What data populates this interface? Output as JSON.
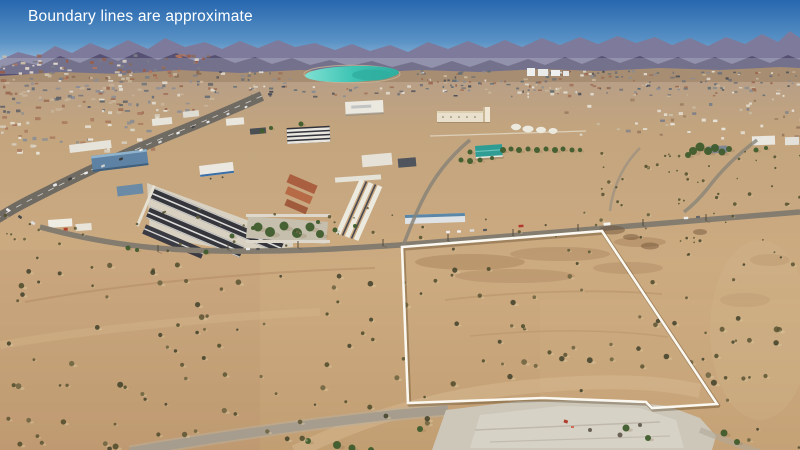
{
  "caption": {
    "text": "Boundary lines are approximate"
  },
  "palette": {
    "sky_top": "#2767ae",
    "sky_mid": "#5b93c6",
    "sky_horizon": "#aac6dd",
    "mtn_far": "#7d7a9b",
    "mtn_near": "#565072",
    "foothills": "#a78d72",
    "desert_distant": "#b89f86",
    "desert_mid": "#c6a67e",
    "desert_fore": "#c29e73",
    "pond_light": "#7fe0d2",
    "pond": "#3fc4b4",
    "pond_deep": "#2fae9f",
    "road_paved": "#6f6a62",
    "road_frontage": "#837c6f",
    "road_dirt": "#a69d8e",
    "pad": "#cdc7ba",
    "wash": "#d9bd94",
    "shrub_shadow": "#dcc9a0",
    "tree": "#3f5c2d",
    "boundary": "#faf8f0",
    "caption_color": "#ffffff"
  },
  "boundary": {
    "points": "402,247 602,231 717,404 652,408 646,402 543,398 408,403",
    "stroke_width": 2.6
  },
  "seed": 7,
  "textures": [
    {
      "id": "specks-town-left-upper",
      "x": 0,
      "y": 54,
      "w": 212,
      "h": 24,
      "count": 95,
      "type": "rect",
      "wMin": 2,
      "wMax": 5,
      "hMin": 1.5,
      "hMax": 3,
      "colors": [
        "#9b5c45",
        "#b4755a",
        "#e0d8cc",
        "#7b7d85",
        "#8a6a55",
        "#cdbfa8"
      ]
    },
    {
      "id": "specks-town-left-lower",
      "x": 0,
      "y": 78,
      "w": 212,
      "h": 34,
      "count": 120,
      "type": "rect",
      "wMin": 2,
      "wMax": 5.5,
      "hMin": 1.5,
      "hMax": 3,
      "colors": [
        "#e6e2d8",
        "#8d8d95",
        "#9b6b52",
        "#6b7078",
        "#c8b49a",
        "#5e6066"
      ]
    },
    {
      "id": "specks-town-far",
      "x": 212,
      "y": 70,
      "w": 588,
      "h": 26,
      "count": 300,
      "type": "rect",
      "wMin": 1.5,
      "wMax": 4.5,
      "hMin": 1.2,
      "hMax": 2.6,
      "avoid": [
        [
          298,
          62,
          108,
          24
        ]
      ],
      "colors": [
        "#6f7076",
        "#e6e2d8",
        "#9b6b52",
        "#5a6a74",
        "#c9b79b",
        "#8a8d93",
        "#4e5058"
      ]
    },
    {
      "id": "specks-town-near-left",
      "x": 0,
      "y": 112,
      "w": 160,
      "h": 40,
      "count": 48,
      "type": "rect",
      "wMin": 2.5,
      "wMax": 6,
      "hMin": 2,
      "hMax": 3.5,
      "colors": [
        "#eae6dc",
        "#d8d2c4",
        "#8a8d93",
        "#a8795e"
      ]
    },
    {
      "id": "specks-houses-right",
      "x": 560,
      "y": 98,
      "w": 240,
      "h": 40,
      "count": 46,
      "type": "rect",
      "wMin": 2,
      "wMax": 5,
      "hMin": 1.6,
      "hMax": 3,
      "colors": [
        "#e8e4da",
        "#7d7f88",
        "#9a7a5e",
        "#c9bfa8"
      ]
    },
    {
      "id": "shrubs-mid",
      "x": 0,
      "y": 208,
      "w": 800,
      "h": 52,
      "count": 60,
      "type": "shrub",
      "rMin": 0.8,
      "rMax": 1.8,
      "colors": [
        "#55512e",
        "#46452a",
        "#5f5a38"
      ]
    },
    {
      "id": "shrubs-fore",
      "x": 0,
      "y": 260,
      "w": 800,
      "h": 190,
      "count": 170,
      "type": "shrub",
      "rMin": 1.2,
      "rMax": 3,
      "avoid": [
        [
          430,
          396,
          292,
          56
        ]
      ],
      "colors": [
        "#4c4a2a",
        "#3f412a",
        "#5a5332",
        "#6b6240"
      ]
    },
    {
      "id": "shrubs-right-mid",
      "x": 600,
      "y": 150,
      "w": 200,
      "h": 60,
      "count": 42,
      "type": "shrub",
      "rMin": 0.8,
      "rMax": 1.8,
      "colors": [
        "#55512e",
        "#4a4a2c"
      ]
    }
  ],
  "trees": [
    [
      503,
      150,
      3
    ],
    [
      511,
      149,
      2.5
    ],
    [
      519,
      150,
      3
    ],
    [
      528,
      149,
      2.5
    ],
    [
      537,
      150,
      3
    ],
    [
      546,
      149,
      2.5
    ],
    [
      555,
      150,
      3
    ],
    [
      563,
      149,
      2.5
    ],
    [
      572,
      150,
      2.5
    ],
    [
      580,
      150,
      2.2
    ],
    [
      470,
      161,
      3
    ],
    [
      461,
      160,
      2.5
    ],
    [
      470,
      152,
      2.5
    ],
    [
      480,
      160,
      2.5
    ],
    [
      492,
      158,
      2
    ],
    [
      693,
      151,
      4
    ],
    [
      700,
      147,
      4.5
    ],
    [
      708,
      151,
      4
    ],
    [
      715,
      148,
      4
    ],
    [
      722,
      152,
      3.5
    ],
    [
      729,
      149,
      3
    ],
    [
      688,
      155,
      3
    ],
    [
      756,
      150,
      2.5
    ],
    [
      766,
      148,
      2
    ],
    [
      262,
      131,
      2.5
    ],
    [
      271,
      128,
      2
    ],
    [
      301,
      124,
      2.5
    ],
    [
      128,
      248,
      2.5
    ],
    [
      137,
      250,
      2
    ],
    [
      206,
      252,
      2.5
    ],
    [
      232,
      236,
      2.5
    ],
    [
      253,
      228,
      2
    ],
    [
      335,
      230,
      2.5
    ],
    [
      355,
      226,
      2
    ],
    [
      318,
      222,
      2
    ],
    [
      258,
      227,
      4.5
    ],
    [
      270,
      232,
      5
    ],
    [
      284,
      226,
      4.5
    ],
    [
      297,
      233,
      5
    ],
    [
      310,
      227,
      4.5
    ],
    [
      320,
      234,
      4
    ],
    [
      626,
      428,
      3.5
    ],
    [
      648,
      438,
      3
    ],
    [
      724,
      433,
      3.5
    ],
    [
      737,
      442,
      3
    ],
    [
      420,
      429,
      3
    ],
    [
      337,
      445,
      4
    ],
    [
      352,
      448,
      3.5
    ],
    [
      308,
      441,
      3
    ],
    [
      371,
      450,
      3
    ]
  ],
  "vehicles": [
    {
      "id": "vehicles-parcel-road",
      "angle": -4,
      "items": [
        [
          448,
          232,
          4,
          2.4,
          "#ececec"
        ],
        [
          459,
          231.5,
          4,
          2.4,
          "#f2f2f2"
        ],
        [
          472,
          230.5,
          4.5,
          2.4,
          "#dcdcdc"
        ],
        [
          485,
          230,
          4,
          2.2,
          "#5a5a5a"
        ],
        [
          521,
          226,
          5,
          2.6,
          "#b03a2e"
        ],
        [
          607,
          224,
          7,
          3,
          "#f5f3ee"
        ],
        [
          686,
          218,
          4.5,
          2.4,
          "#eeeeee"
        ],
        [
          698,
          217,
          4,
          2.2,
          "#666666"
        ],
        [
          248,
          249,
          4,
          2.4,
          "#e8e8e8"
        ],
        [
          258,
          249,
          3.6,
          2.2,
          "#555555"
        ]
      ]
    },
    {
      "id": "vehicles-highway",
      "angle": -24,
      "items": [
        [
          55,
          185,
          4,
          2.6,
          "#e8e8e8"
        ],
        [
          70,
          179,
          4,
          2.6,
          "#3f3f3f"
        ],
        [
          86,
          173,
          4,
          2.4,
          "#ececec"
        ],
        [
          103,
          166,
          4,
          2.4,
          "#cfcfcf"
        ],
        [
          121,
          159,
          4,
          2.4,
          "#3a3a3a"
        ],
        [
          141,
          150,
          3.6,
          2.2,
          "#e8e8e8"
        ],
        [
          160,
          142,
          3.6,
          2.2,
          "#d8d8d8"
        ],
        [
          178,
          133,
          3.6,
          2.2,
          "#eeeeee"
        ],
        [
          193,
          127,
          3.4,
          2,
          "#474747"
        ],
        [
          208,
          122,
          3.4,
          2,
          "#e8e8e8"
        ],
        [
          228,
          114,
          3.2,
          2,
          "#dddddd"
        ],
        [
          246,
          107,
          3,
          1.8,
          "#e8e8e8"
        ]
      ]
    },
    {
      "id": "vehicles-left-road",
      "angle": 36,
      "items": [
        [
          8,
          210,
          4,
          2.6,
          "#e8e8e8"
        ],
        [
          20,
          217,
          4,
          2.6,
          "#4a4a4a"
        ],
        [
          33,
          223,
          4.5,
          2.6,
          "#dddddd"
        ]
      ]
    }
  ],
  "poles": [
    [
      383,
      246
    ],
    [
      448,
      241
    ],
    [
      513,
      236
    ],
    [
      578,
      231
    ],
    [
      643,
      226
    ],
    [
      706,
      221
    ],
    [
      158,
      252
    ],
    [
      228,
      250
    ],
    [
      298,
      248
    ]
  ],
  "stains": [
    [
      612,
      230,
      13,
      4.5
    ],
    [
      631,
      237,
      8,
      3
    ],
    [
      650,
      246,
      9,
      3.5
    ],
    [
      700,
      232,
      7,
      3
    ]
  ]
}
